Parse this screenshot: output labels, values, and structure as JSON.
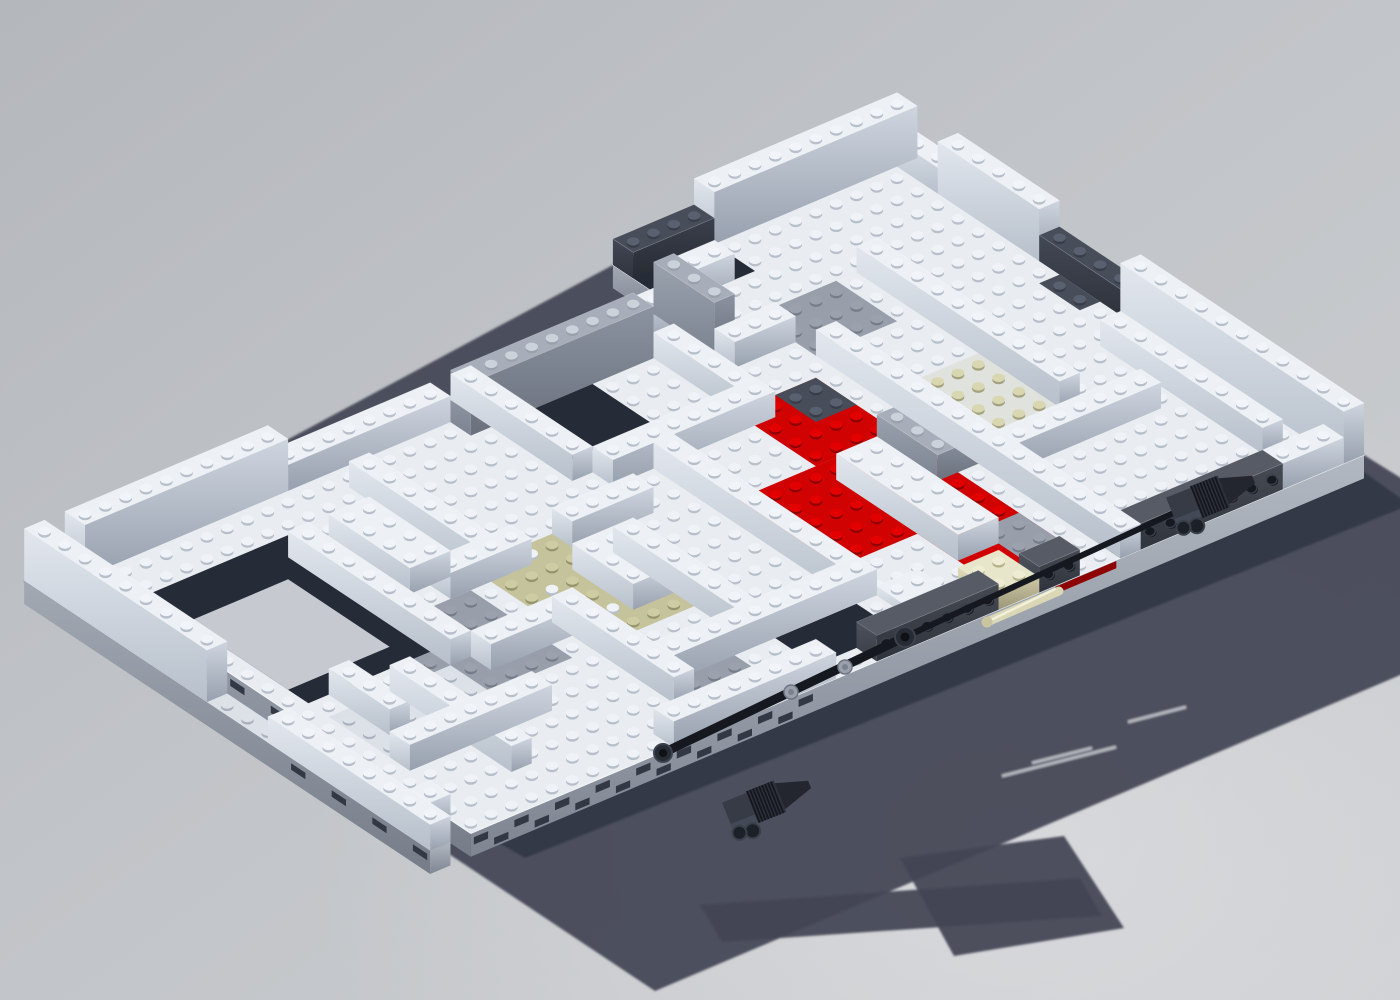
{
  "meta": {
    "description": "3D computer render of a partially built LEGO chassis: white brick walls forming maze-like compartments on a baseplate, red and tan plate accents, dark gray Technic beams with black axles and ribbed engine blocks along the front edge, casting a large blocky shadow on a plain gray ground"
  },
  "scene": {
    "background": {
      "top_left": "#b4b7bc",
      "middle": "#c1c4c8",
      "bottom_right": "#cdcfd2",
      "glow": "#e3e4e6"
    },
    "shadow": {
      "fill": "#424654",
      "opacity": 0.93,
      "hull": [
        [
          897,
          145
        ],
        [
          1364,
          455
        ],
        [
          1589,
          595
        ],
        [
          655,
          991
        ],
        [
          249,
          721
        ],
        [
          24,
          581
        ],
        [
          613,
          265
        ]
      ],
      "lumps": [
        [
          [
            700,
            905
          ],
          [
            1080,
            878
          ],
          [
            1102,
            916
          ],
          [
            722,
            942
          ]
        ],
        [
          [
            900,
            858
          ],
          [
            1064,
            836
          ],
          [
            1124,
            928
          ],
          [
            954,
            956
          ]
        ]
      ],
      "contact": {
        "points": [
          [
            1364,
            472
          ],
          [
            471,
            827
          ],
          [
            525,
            858
          ],
          [
            1410,
            505
          ]
        ],
        "fill": "#313644",
        "opacity": 0.85
      },
      "slits": [
        [
          1002,
          776,
          1116,
          747
        ],
        [
          1032,
          763,
          1092,
          748
        ],
        [
          1128,
          722,
          1186,
          707
        ]
      ],
      "slit_color": "#c3c6cc"
    },
    "grid": {
      "origin": [
        958,
        185
      ],
      "u_vec": [
        -20.3,
        8.6
      ],
      "v_vec": [
        20.3,
        13.5
      ],
      "brick_h": 26,
      "u_size": 44,
      "v_size": 20
    },
    "palette": {
      "floor": {
        "top": "#e9edf2",
        "stud": "#eff3f8",
        "shade": "#b7bfcb"
      },
      "white": {
        "top": "#edf1f6",
        "stud": "#f1f4f9",
        "shade": "#b7bfcb",
        "sideU": [
          "#e2e7ee",
          "#b7c0cb"
        ],
        "sideV": [
          "#ced5df",
          "#97a0ae"
        ]
      },
      "pale": {
        "top": "#dce1e8",
        "stud": "#dde2e9",
        "shade": "#aab2bf",
        "sideU": [
          "#d0d6de",
          "#a8b0bc"
        ],
        "sideV": [
          "#c0c7d1",
          "#8e97a5"
        ]
      },
      "plain": {
        "top": "#c6cad0",
        "nostud": true
      },
      "stone": {
        "top": "#a7aeb9",
        "stud": "#ccd2da",
        "shade": "#99a1ad",
        "sideU": [
          "#9aa2ae",
          "#7d8491"
        ],
        "sideV": [
          "#8b93a0",
          "#6a717d"
        ]
      },
      "slate": {
        "top": "#474d59",
        "stud": "#596070",
        "shade": "#383d49",
        "sideU": [
          "#424854",
          "#2f333d"
        ],
        "sideV": [
          "#3a404b",
          "#272b34"
        ]
      },
      "gray": {
        "top": "#989fab",
        "stud": "#9ba2ad",
        "shade": "#767d89",
        "sideU": [
          "#8d94a1",
          "#707783"
        ],
        "sideV": [
          "#818895",
          "#636a76"
        ]
      },
      "olive": {
        "top": "#c5c39b",
        "stud": "#cecca2",
        "shade": "#96946d",
        "sideU": [
          "#b4b28c",
          "#8e8c69"
        ],
        "sideV": [
          "#a4a27d",
          "#7c7a5b"
        ]
      },
      "olive2": {
        "top": "#dfe2dd",
        "stud": "#d9d7b2",
        "shade": "#a4a27e"
      },
      "navy": {
        "top": "#262b38",
        "nostud": true,
        "sideU": [
          "#232833",
          "#171a22"
        ],
        "sideV": [
          "#1e222c",
          "#12151c"
        ]
      },
      "red": {
        "top": "#d00202",
        "stud": "#e30000",
        "shade": "#8e0000",
        "sideU": [
          "#c00000",
          "#8a0000"
        ],
        "sideV": [
          "#a80000",
          "#6f0000"
        ]
      },
      "cream": {
        "top": "#e8e6ca",
        "stud": "#eeecd2",
        "shade": "#b5b28c",
        "sideU": [
          "#ded9b8",
          "#b3ae8c"
        ],
        "sideV": [
          "#cdc8a6",
          "#9b9677"
        ]
      },
      "tech": {
        "top": "#565b65",
        "nostud": true,
        "sideU": [
          "#4d525c",
          "#383c45"
        ],
        "sideV": [
          "#454a53",
          "#2f333b"
        ]
      }
    },
    "slab": {
      "floor_color": "#e9edf2",
      "depth": 0.9,
      "outline": [
        [
          0,
          -3
        ],
        [
          14,
          -3
        ],
        [
          14,
          0
        ],
        [
          44,
          0
        ],
        [
          44,
          20
        ],
        [
          0,
          20
        ]
      ],
      "front_face_grad": [
        "#b2b8c1",
        "#7f8692"
      ],
      "left_face_grad": [
        "#a2a9b3",
        "#767d89"
      ],
      "slot_fill": "#333845",
      "red_sliver": {
        "u1": 12.2,
        "u2": 15.2,
        "fill": "#8e0404"
      }
    },
    "strip": {
      "u": 45,
      "v1": 0,
      "v2": 20
    },
    "regions": [
      [
        13,
        6,
        17,
        10,
        "red"
      ],
      [
        13,
        10,
        21,
        19,
        "red"
      ],
      [
        17,
        15,
        21,
        19,
        "floor"
      ],
      [
        13,
        16,
        15,
        19,
        "gray"
      ],
      [
        13,
        6,
        15,
        8,
        "slate"
      ],
      [
        26,
        8,
        32,
        14,
        "olive"
      ],
      [
        6,
        8,
        10,
        13,
        "olive2"
      ],
      [
        33,
        9,
        38,
        14,
        "gray"
      ],
      [
        0,
        9,
        2,
        13,
        "gray"
      ],
      [
        8,
        2,
        12,
        5,
        "gray"
      ],
      [
        28,
        16,
        31,
        19,
        "gray"
      ],
      [
        37,
        12,
        43,
        16,
        "pale"
      ],
      [
        1,
        6,
        2,
        8,
        "slate"
      ],
      [
        10,
        -3,
        14,
        0,
        "navy"
      ],
      [
        36,
        3,
        43,
        11,
        "navy"
      ],
      [
        20,
        1,
        24,
        5,
        "navy"
      ],
      [
        22,
        17,
        26,
        19,
        "navy"
      ],
      [
        38,
        5,
        43,
        10,
        "plain"
      ]
    ],
    "walls": [
      [
        0,
        -3,
        10,
        "u",
        2
      ],
      [
        10,
        -3,
        4,
        "u",
        1,
        "slate"
      ],
      [
        0,
        -3,
        3,
        "v",
        1
      ],
      [
        11,
        -1,
        3,
        "u",
        1
      ],
      [
        14,
        0,
        3,
        "u",
        1
      ],
      [
        14,
        0,
        3,
        "v",
        2,
        "stone"
      ],
      [
        17,
        1,
        9,
        "u",
        2,
        "stone"
      ],
      [
        26,
        0,
        8,
        "u",
        1
      ],
      [
        34,
        0,
        10,
        "u",
        2
      ],
      [
        0,
        0,
        5,
        "v",
        2
      ],
      [
        0,
        5,
        4,
        "v",
        1,
        "slate"
      ],
      [
        0,
        9,
        11,
        "v",
        2
      ],
      [
        45,
        0,
        9,
        "v",
        2
      ],
      [
        45,
        12,
        8,
        "v",
        1
      ],
      [
        1,
        19,
        3,
        "u",
        1
      ],
      [
        4,
        19,
        8,
        "u",
        1,
        "tech",
        1
      ],
      [
        14,
        19,
        2,
        "u",
        1,
        "tech",
        1
      ],
      [
        18,
        19,
        6,
        "u",
        1,
        "tech",
        1
      ],
      [
        26,
        19,
        8,
        "u",
        1
      ],
      [
        6,
        2,
        10,
        "v",
        1
      ],
      [
        11,
        5,
        15,
        "v",
        1
      ],
      [
        16,
        2,
        4,
        "v",
        1
      ],
      [
        21,
        7,
        10,
        "v",
        1
      ],
      [
        24,
        0,
        6,
        "v",
        1
      ],
      [
        26,
        10,
        6,
        "v",
        1
      ],
      [
        31,
        2,
        7,
        "v",
        1
      ],
      [
        31,
        12,
        6,
        "v",
        1
      ],
      [
        36,
        4,
        8,
        "v",
        1
      ],
      [
        39,
        12,
        6,
        "v",
        1
      ],
      [
        2,
        10,
        8,
        "v",
        1
      ],
      [
        16,
        6,
        8,
        "u",
        1
      ],
      [
        24,
        8,
        4,
        "u",
        1
      ],
      [
        30,
        8,
        4,
        "u",
        1
      ],
      [
        4,
        13,
        7,
        "u",
        1
      ],
      [
        31,
        12,
        5,
        "u",
        1
      ],
      [
        21,
        16,
        10,
        "u",
        1
      ],
      [
        36,
        15,
        7,
        "u",
        1
      ],
      [
        44,
        18,
        1,
        "u",
        1
      ],
      [
        12,
        3,
        3,
        "u",
        1
      ]
    ],
    "bricks": [
      [
        15,
        11,
        2,
        6,
        1,
        "white"
      ],
      [
        12,
        10,
        2,
        3,
        1,
        "stone"
      ],
      [
        33,
        4,
        2,
        4,
        1,
        "white"
      ],
      [
        27,
        10,
        2,
        3,
        1,
        "white"
      ],
      [
        41,
        11,
        1,
        3,
        1,
        "white"
      ],
      [
        16,
        18,
        2,
        2,
        0.6,
        "cream"
      ],
      [
        19,
        17,
        2,
        2,
        0.35,
        "white"
      ]
    ],
    "technic": {
      "axles": [
        [
          1245,
          480,
          905,
          637,
          6
        ],
        [
          905,
          637,
          663,
          753,
          9
        ]
      ],
      "axle_color": "#15181e",
      "balls": [
        [
          905,
          637,
          10
        ],
        [
          663,
          753,
          9
        ]
      ],
      "bushes": [
        [
          845,
          667
        ],
        [
          791,
          692
        ]
      ],
      "engines": [
        [
          1222,
          492
        ],
        [
          778,
          797
        ]
      ],
      "engine_angle": 158.3,
      "hinge": {
        "line": [
          1059,
          591,
          987,
          622
        ],
        "width": 9,
        "body": "#dad7b5",
        "highlight": "#f2f0da",
        "cap": "#c9c5a0"
      }
    }
  }
}
